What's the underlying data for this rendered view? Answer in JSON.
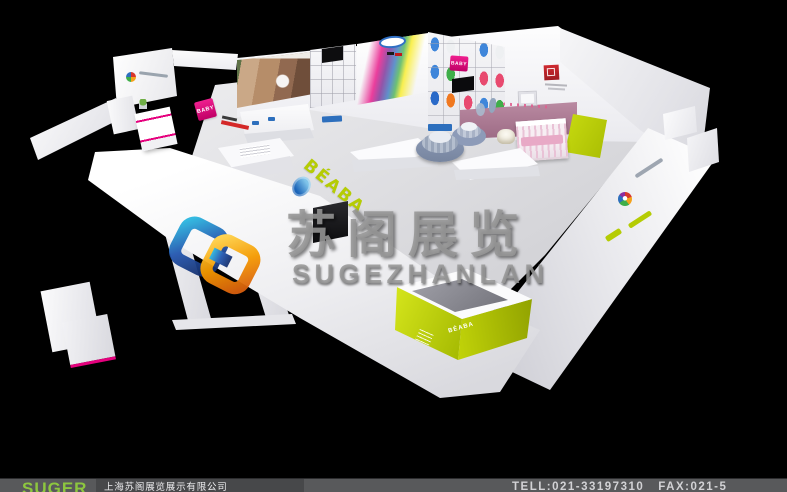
{
  "colors": {
    "bg": "#000000",
    "lime": "#b5cc04",
    "magenta": "#e5007d",
    "blue": "#2d6fbd",
    "red_logo": "#c9252c",
    "mauve": "#b287a0",
    "wall_white": "#f5f5f7",
    "floor_gray": "#d8d8dc",
    "watermark_gray": "#969696",
    "footer_bg": "#58595b",
    "footer_box": "#47484a",
    "footer_green": "#8dc63f",
    "footer_text": "#d2d2d5"
  },
  "watermark": {
    "title": "苏阁展览",
    "subtitle": "SUGEZHANLAN"
  },
  "booth": {
    "front_brand": "BÉABA",
    "counter_brand": "BÉABA",
    "baby_logo": "BABY"
  },
  "footer": {
    "logo": "SUGER",
    "company": "上海苏阁展览展示有限公司",
    "tel": "TELL:021-33197310",
    "fax": "FAX:021-5"
  }
}
